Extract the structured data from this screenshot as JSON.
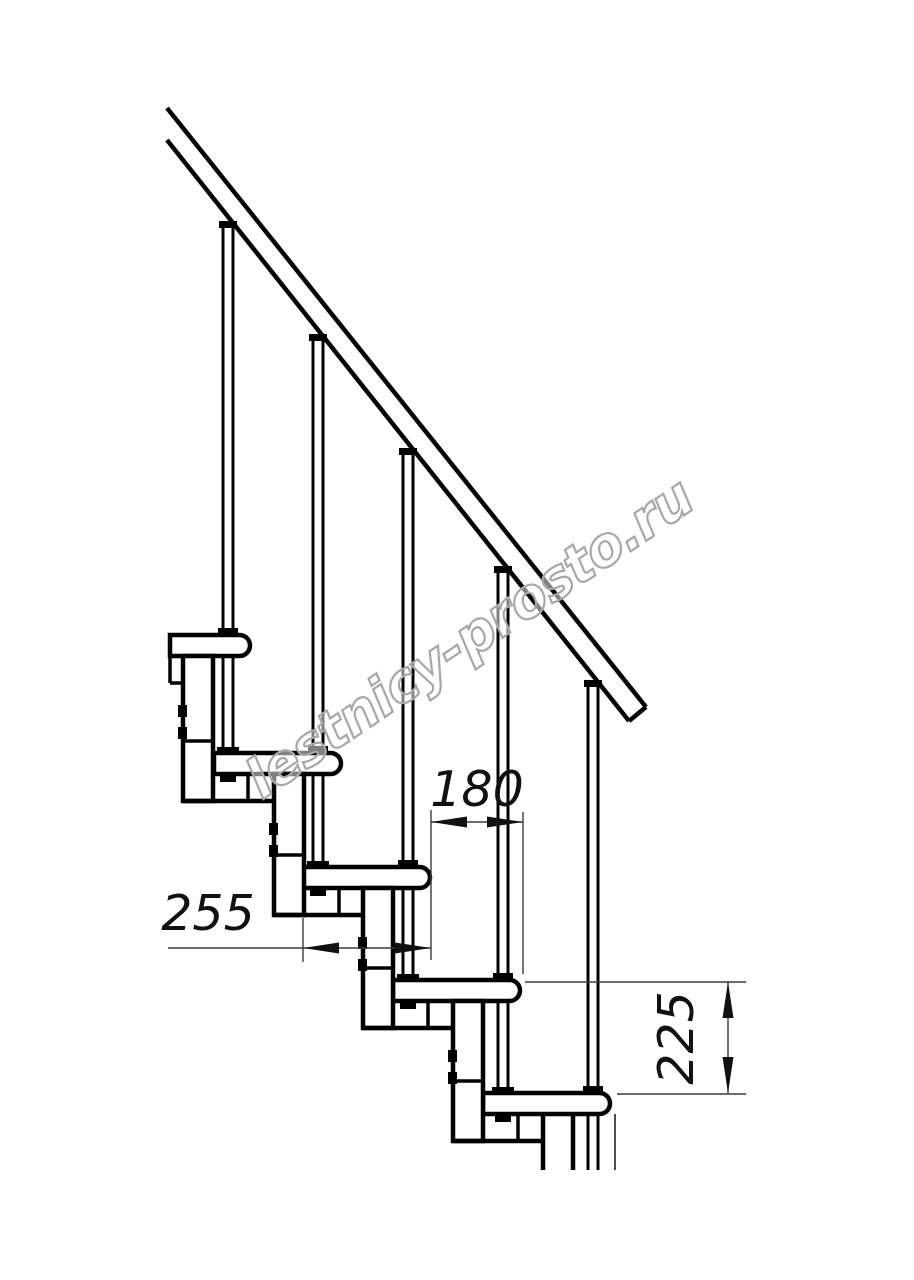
{
  "page": {
    "width": 914,
    "height": 1280,
    "background": "#ffffff"
  },
  "watermark": {
    "text": "lestnicy-prosto.ru",
    "x": 262,
    "y": 800,
    "rotation": -34,
    "font_size": 54,
    "fill_color": "rgba(255,255,255,0.5)",
    "outline_color": "#a8a8a8"
  },
  "drawing": {
    "ink_color": "#000000",
    "thin_color": "#3c3c3c",
    "paper_color": "#ffffff",
    "stroke_main": 4.5,
    "stroke_baluster": 3,
    "stroke_thin": 1.4,
    "clip_bottom": 1170,
    "rail": {
      "top_line": [
        167,
        108,
        646,
        707
      ],
      "bottom_line": [
        167,
        140,
        629,
        721
      ],
      "end_cap": [
        646,
        707,
        629,
        721
      ],
      "band": [
        [
          167,
          108
        ],
        [
          646,
          707
        ],
        [
          629,
          721
        ],
        [
          167,
          140
        ]
      ]
    },
    "treads": {
      "tops": [
        635,
        753,
        867,
        980,
        1093
      ],
      "lefts": [
        123,
        214,
        303,
        393,
        483
      ],
      "width": 127,
      "height": 21,
      "end_radius": 10.5,
      "first_clip_x": 170
    },
    "modules": {
      "offset_x": 60,
      "width": 30,
      "foot_extend": 48,
      "divider_above_next": 12,
      "plate_span": 90,
      "connector_offset": 65,
      "bolt_offsets_y": [
        70,
        92
      ],
      "bolt_w": 9,
      "bolt_h": 12
    },
    "balusters": {
      "centers": [
        228,
        318,
        408,
        503,
        593
      ],
      "half_gap": 5,
      "cap_y": [
        221,
        334,
        448,
        566,
        680
      ],
      "cap_w": 18,
      "cap_h": 7,
      "collar_w": 20,
      "collar_h": 7,
      "foot_w": 22,
      "foot_h": 6,
      "nut_w": 16,
      "nut_h": 7
    },
    "extra_lines": [
      [
        170,
        683,
        183,
        683
      ],
      [
        170,
        656,
        170,
        683
      ],
      [
        615,
        1114,
        615,
        1170
      ]
    ],
    "arrow": {
      "length": 36,
      "half_width": 5.5
    },
    "dim_font_size": 49,
    "dimensions": [
      {
        "name": "step-run",
        "value": "180",
        "text": {
          "x": 477,
          "y": 806,
          "rotate": 0
        },
        "line": [
          431,
          822,
          523,
          822
        ],
        "extensions": [
          [
            431,
            810,
            431,
            960
          ],
          [
            523,
            812,
            523,
            974
          ]
        ],
        "arrows": [
          {
            "x": 431,
            "y": 822,
            "dir": "left"
          },
          {
            "x": 523,
            "y": 822,
            "dir": "right"
          }
        ]
      },
      {
        "name": "tread-depth",
        "value": "255",
        "text": {
          "x": 208,
          "y": 930,
          "rotate": 0
        },
        "line": [
          168,
          948,
          431,
          948
        ],
        "extensions": [
          [
            303,
            918,
            303,
            962
          ]
        ],
        "arrows": [
          {
            "x": 303,
            "y": 948,
            "dir": "left"
          },
          {
            "x": 431,
            "y": 948,
            "dir": "right"
          }
        ]
      },
      {
        "name": "riser-height",
        "value": "225",
        "text": {
          "x": 693,
          "y": 1038,
          "rotate": -90
        },
        "line": [
          728,
          982,
          728,
          1093
        ],
        "extensions": [
          [
            525,
            982,
            746,
            982
          ],
          [
            617,
            1094,
            746,
            1094
          ]
        ],
        "arrows": [
          {
            "x": 728,
            "y": 982,
            "dir": "up"
          },
          {
            "x": 728,
            "y": 1093,
            "dir": "down"
          }
        ]
      }
    ]
  }
}
